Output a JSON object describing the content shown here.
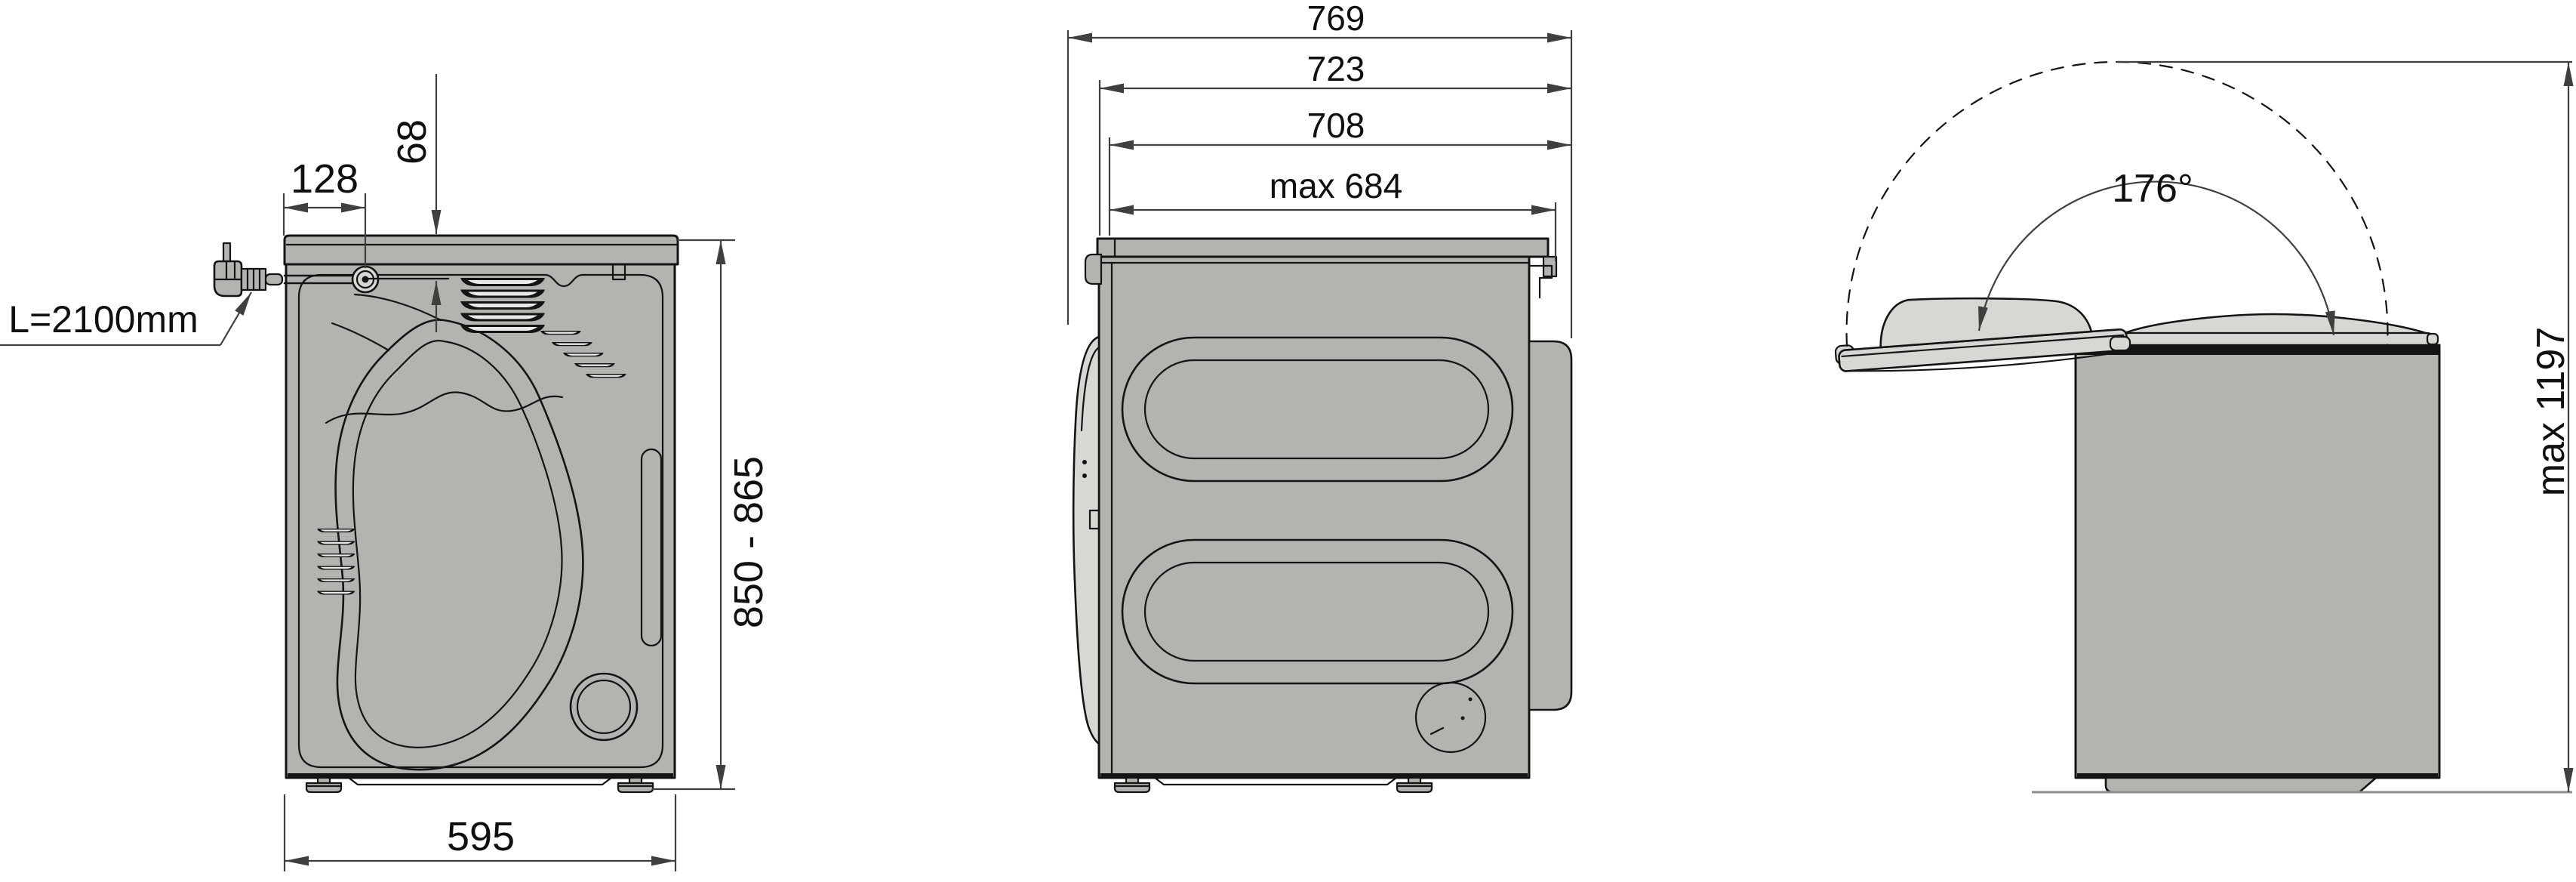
{
  "colors": {
    "background": "#ffffff",
    "outline": "#141414",
    "dim": "#3f3f3f",
    "body_fill": "#b5b3b0",
    "lid_fill": "#d9d7d3",
    "vent_core": "#ebeae8",
    "ground": "#8f8f8f",
    "text": "#101010"
  },
  "views": {
    "rear": {
      "name": "rear-view",
      "dimensions": {
        "cord_offset_x": "128",
        "cord_offset_y": "68",
        "cord_length": "L=2100mm",
        "height_range": "850 - 865",
        "width": "595"
      }
    },
    "side": {
      "name": "side-view",
      "dimensions": {
        "depth_overall": "769",
        "depth_with_door": "723",
        "depth_body": "708",
        "depth_worktop": "max 684"
      }
    },
    "lid": {
      "name": "side-view-open-lid",
      "dimensions": {
        "opening_angle": "176°",
        "height_open_max": "max 1197"
      }
    }
  }
}
